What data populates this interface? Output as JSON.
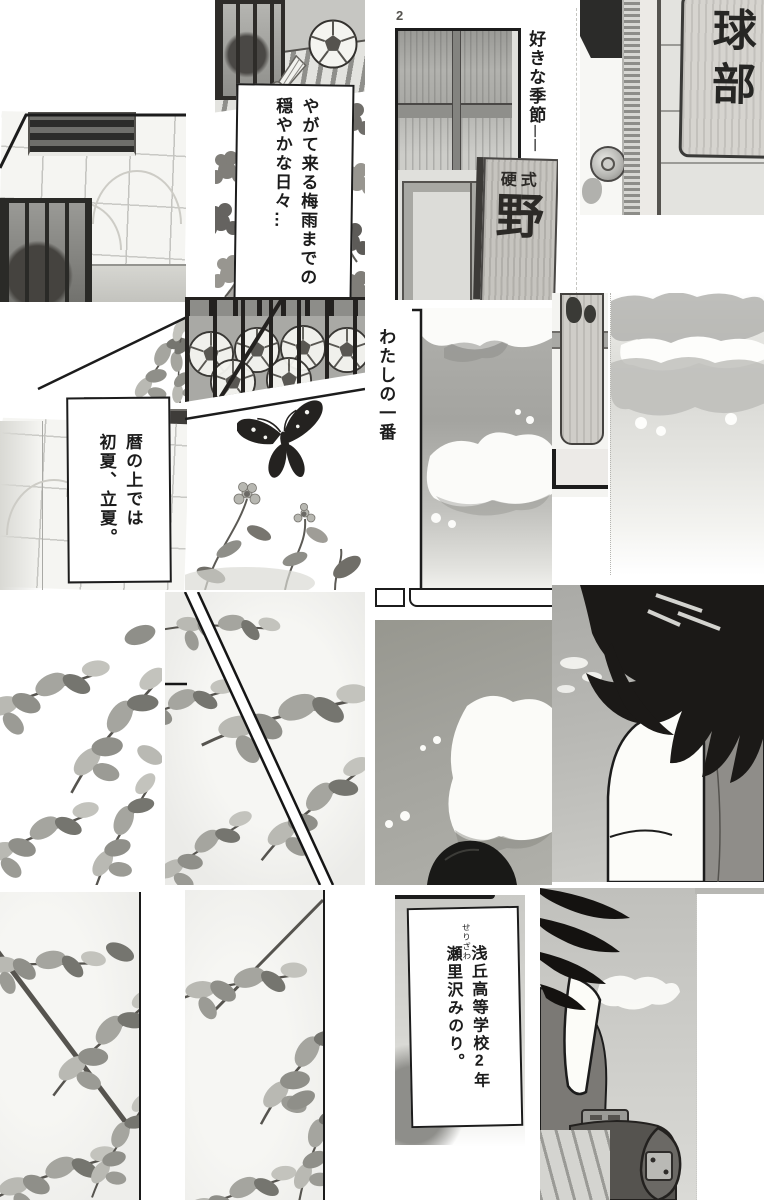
{
  "page": {
    "number": "2"
  },
  "colors": {
    "paper": "#ffffff",
    "ink": "#1c1c1c",
    "wash_light": "#e9e9e5",
    "wash_mid": "#b5b5b1",
    "wash_dark": "#8d8d89",
    "sky_gray": "#a8a8a4",
    "hair_black": "#1b1917"
  },
  "captions": {
    "mild_days": {
      "line1": "やがて来る梅雨までの",
      "line2": "穏やかな日々…"
    },
    "favorite_season": {
      "text": "好きな季節──"
    },
    "my_number_one": {
      "text": "わたしの一番"
    },
    "calendar": {
      "line1": "暦の上では",
      "line2": "初夏、立夏。"
    },
    "introduction": {
      "line1": "浅丘高等学校2年",
      "line2": "瀬里沢みのり。",
      "furigana": "せりざわ"
    }
  },
  "signs": {
    "door_plaque": "球部",
    "club_sign_small": "硬式",
    "club_sign_large": "野"
  }
}
